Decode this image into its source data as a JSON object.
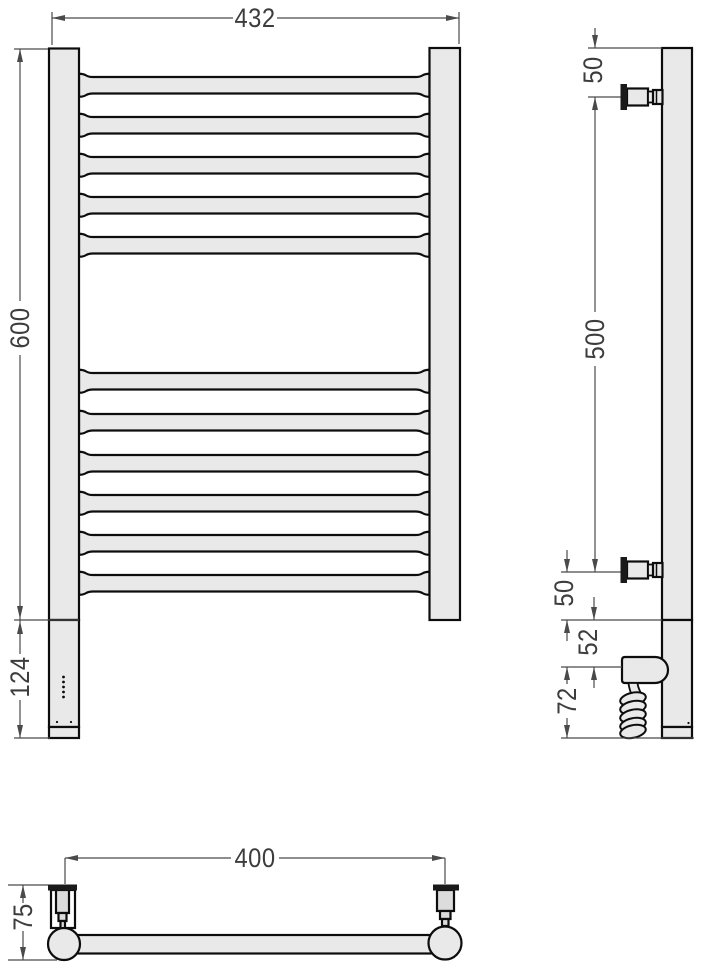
{
  "meta": {
    "description": "Technical dimension drawing of an electric ladder towel rail: front view, side view and top view"
  },
  "colors": {
    "background": "#ffffff",
    "fill": "#e9e9e9",
    "fill_dark": "#dcdcdc",
    "white": "#ffffff",
    "outline": "#0d0d0d",
    "flange": "#1a1a1a",
    "dim_line": "#4a4a4a",
    "label": "#3d3d3d"
  },
  "front_view": {
    "bars": {
      "x0": 79,
      "x1": 429.5,
      "tube_h": 16.5,
      "collar_h": 23,
      "collar_w": 14,
      "tops": [
        77,
        117,
        157,
        197,
        237,
        373,
        414,
        455,
        495,
        535,
        575
      ]
    },
    "rects": [
      {
        "name": "front-left-post",
        "x": 49,
        "y": 48.5,
        "w": 30,
        "h": 571.5,
        "fill": "fill"
      },
      {
        "name": "front-heater-body",
        "x": 49,
        "y": 620,
        "w": 30,
        "h": 107,
        "fill": "fill"
      },
      {
        "name": "front-heater-cap",
        "x": 49,
        "y": 727,
        "w": 30,
        "h": 11,
        "fill": "fill"
      },
      {
        "name": "front-right-post",
        "x": 429.5,
        "y": 48,
        "w": 30.5,
        "h": 572,
        "fill": "fill"
      }
    ],
    "indicator_dots": [
      [
        63.5,
        677
      ],
      [
        63.5,
        682
      ],
      [
        63.5,
        687
      ],
      [
        63.5,
        692
      ],
      [
        63.5,
        697
      ]
    ],
    "screw_dots": [
      [
        57,
        722
      ],
      [
        71,
        722
      ]
    ]
  },
  "side_view": {
    "rects": [
      {
        "name": "side-post",
        "x": 662,
        "y": 48,
        "w": 30,
        "h": 572,
        "fill": "fill"
      },
      {
        "name": "side-heater-body",
        "x": 662,
        "y": 620,
        "w": 30,
        "h": 107,
        "fill": "fill"
      },
      {
        "name": "side-heater-cap",
        "x": 662,
        "y": 727,
        "w": 30,
        "h": 11,
        "fill": "fill"
      }
    ],
    "brackets": [
      {
        "cy": 97
      },
      {
        "cy": 570
      }
    ],
    "housing": {
      "x": 622,
      "y": 657,
      "w": 46,
      "h": 26
    },
    "cable_stub": {
      "x": 628.5,
      "y": 683
    },
    "coil": {
      "cx": 633,
      "rx": 13,
      "ry": 6.3,
      "tilt": -12,
      "cys": [
        699,
        707.5,
        716,
        724.5,
        731.5
      ]
    },
    "screw_dots": [
      [
        688.5,
        723
      ]
    ]
  },
  "bottom_view": {
    "rects": [
      {
        "name": "bottom-bar",
        "x": 64,
        "y": 935,
        "w": 381,
        "h": 18.5,
        "fill": "fill"
      },
      {
        "name": "bottom-left-cup",
        "x": 51,
        "y": 890,
        "w": 24,
        "h": 38,
        "fill": "white"
      },
      {
        "name": "bottom-left-cylinder",
        "x": 56,
        "y": 890,
        "w": 13,
        "h": 23,
        "fill": "fill_dark"
      },
      {
        "name": "bottom-left-neck-1",
        "x": 58.5,
        "y": 913,
        "w": 8,
        "h": 8,
        "fill": "fill_dark"
      },
      {
        "name": "bottom-left-neck-2",
        "x": 60.5,
        "y": 921,
        "w": 4.5,
        "h": 8,
        "fill": "fill_dark"
      },
      {
        "name": "bottom-right-body",
        "x": 437,
        "y": 890,
        "w": 17,
        "h": 21,
        "fill": "fill_dark"
      },
      {
        "name": "bottom-right-neck-1",
        "x": 440,
        "y": 911,
        "w": 10.5,
        "h": 8,
        "fill": "fill_dark"
      },
      {
        "name": "bottom-right-neck-2",
        "x": 442,
        "y": 919,
        "w": 6.5,
        "h": 7,
        "fill": "fill_dark"
      }
    ],
    "circles": [
      {
        "name": "bottom-left-post-section",
        "cx": 64,
        "cy": 944,
        "r": 16
      },
      {
        "name": "bottom-right-post-section",
        "cx": 445,
        "cy": 943,
        "r": 16.5
      }
    ],
    "flanges": [
      {
        "name": "bottom-left-flange",
        "x": 48,
        "y": 884.5,
        "w": 29,
        "h": 6
      },
      {
        "name": "bottom-right-flange",
        "x": 433,
        "y": 884.5,
        "w": 26,
        "h": 6
      }
    ]
  },
  "dimensions": {
    "values_mm": {
      "overall_width": 432,
      "rail_height": 600,
      "heater_section_length": 124,
      "top_to_bracket": 50,
      "bracket_span": 500,
      "bracket_to_joint": 50,
      "joint_to_element": 52,
      "element_housing": 72,
      "bracket_centers_width": 400,
      "wall_depth": 75
    },
    "lines": [
      [
        52,
        12,
        52,
        45
      ],
      [
        459,
        12,
        459,
        44
      ],
      [
        52,
        18,
        233,
        18
      ],
      [
        277,
        18,
        459,
        18
      ],
      [
        14,
        49,
        48,
        49
      ],
      [
        20,
        49,
        20,
        301
      ],
      [
        20,
        355,
        20,
        620
      ],
      [
        14,
        620,
        79,
        620
      ],
      [
        20,
        620,
        20,
        654
      ],
      [
        20,
        700,
        20,
        738
      ],
      [
        14,
        738,
        50,
        738
      ],
      [
        588,
        48,
        662,
        48
      ],
      [
        595,
        28,
        595,
        48
      ],
      [
        588,
        97,
        620.5,
        97
      ],
      [
        595,
        97,
        595,
        312
      ],
      [
        595,
        366,
        595,
        572
      ],
      [
        561,
        572,
        620.5,
        572
      ],
      [
        567,
        550,
        567,
        572
      ],
      [
        567,
        620,
        567,
        641
      ],
      [
        594,
        597,
        594,
        620
      ],
      [
        561,
        620,
        662,
        620
      ],
      [
        594,
        667,
        594,
        688
      ],
      [
        561,
        667,
        622,
        667
      ],
      [
        567,
        667,
        567,
        684
      ],
      [
        567,
        718,
        567,
        738
      ],
      [
        561,
        738,
        694,
        738
      ],
      [
        65,
        858,
        231,
        858
      ],
      [
        279,
        858,
        445,
        858
      ],
      [
        65,
        858,
        65,
        884
      ],
      [
        445,
        858,
        445,
        884
      ],
      [
        8,
        885,
        48,
        885
      ],
      [
        23,
        885,
        23,
        903
      ],
      [
        23,
        931,
        23,
        960
      ],
      [
        8,
        960,
        57,
        960
      ]
    ],
    "arrows": [
      [
        52,
        18,
        "left"
      ],
      [
        459,
        18,
        "right"
      ],
      [
        20,
        49,
        "up"
      ],
      [
        20,
        619,
        "down"
      ],
      [
        20,
        621,
        "up"
      ],
      [
        20,
        738,
        "down"
      ],
      [
        595,
        48,
        "down"
      ],
      [
        595,
        97,
        "up"
      ],
      [
        595,
        572,
        "down"
      ],
      [
        567,
        572,
        "down"
      ],
      [
        567,
        620,
        "up"
      ],
      [
        594,
        620,
        "down"
      ],
      [
        594,
        667,
        "up"
      ],
      [
        567,
        667,
        "up"
      ],
      [
        567,
        738,
        "down"
      ],
      [
        65,
        858,
        "left"
      ],
      [
        445,
        858,
        "right"
      ],
      [
        23,
        885,
        "up"
      ],
      [
        23,
        960,
        "down"
      ]
    ],
    "labels": [
      {
        "id": "dim-overall-width",
        "text": "432"
      },
      {
        "id": "dim-rail-height",
        "text": "600"
      },
      {
        "id": "dim-heater-length",
        "text": "124"
      },
      {
        "id": "dim-top-bracket-offset",
        "text": "50"
      },
      {
        "id": "dim-bracket-span",
        "text": "500"
      },
      {
        "id": "dim-bottom-bracket-offset",
        "text": "50"
      },
      {
        "id": "dim-joint-to-element",
        "text": "52"
      },
      {
        "id": "dim-element-housing",
        "text": "72"
      },
      {
        "id": "dim-bracket-width",
        "text": "400"
      },
      {
        "id": "dim-wall-depth",
        "text": "75"
      }
    ]
  }
}
